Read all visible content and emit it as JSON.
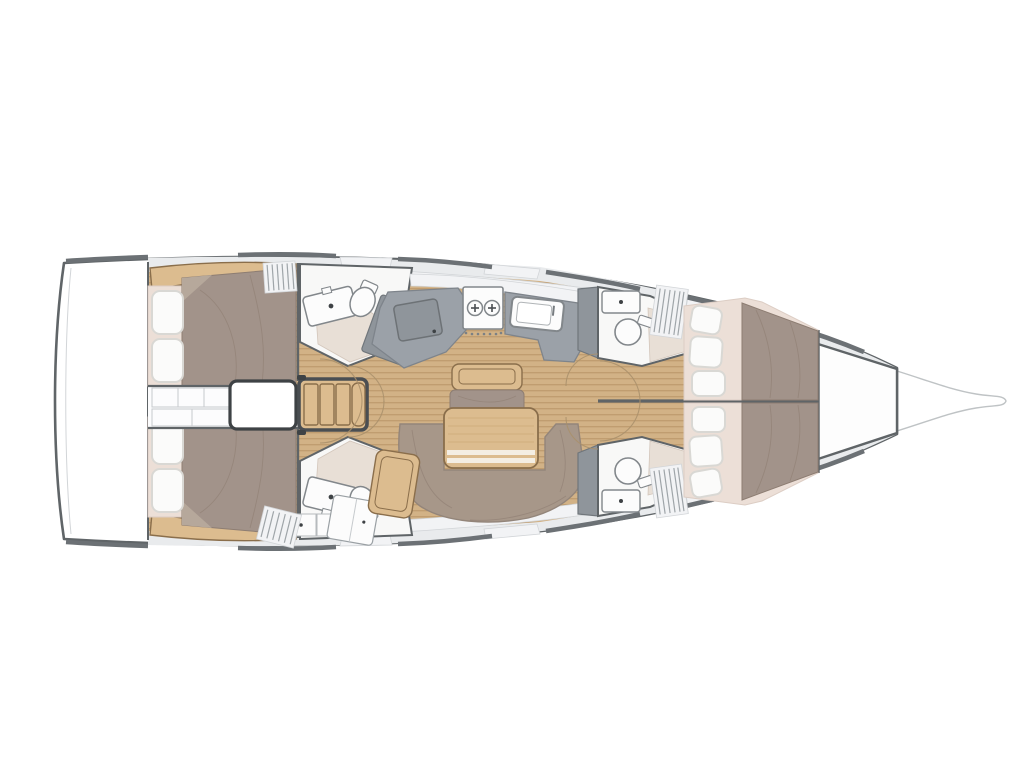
{
  "colors": {
    "bg": "#ffffff",
    "hull": "#606568",
    "rail": "#6c7175",
    "deck": "#e9ebed",
    "deck_seam": "#d2d5d8",
    "panel": "#f2f3f5",
    "wall": "#5f6467",
    "wood": "#d2b286",
    "wood_dark": "#bf9c6e",
    "furn": "#dcbc8f",
    "furn_edge": "#8a6e4b",
    "counter": "#9ba1a8",
    "counter_dark": "#7e848b",
    "locker": "#8f959b",
    "duvet": "#a2938a",
    "duvet_shade": "#8d7d72",
    "sofa": "#a79789",
    "cream": "#ecdfd7",
    "shower": "#e8dfd6",
    "pillow": "#fbfbfa",
    "pillow_edge": "#d9d8d4",
    "white_room": "#f8f8f7",
    "arc": "#a98f6b",
    "hatchln": "#9fa5a9",
    "handle": "#3e4245"
  },
  "plan": {
    "type": "sailboat-interior-floor-plan",
    "orientation": "bow-right",
    "cabins": [
      "aft-cabin-port",
      "aft-cabin-starboard",
      "forward-cabin-port",
      "forward-cabin-starboard"
    ],
    "heads": [
      "aft-head-port",
      "aft-head-starboard",
      "forward-head-port",
      "forward-head-starboard"
    ],
    "zones": [
      "stern-platform",
      "engine-compartment",
      "companionway-stairs",
      "galley",
      "salon",
      "nav-seat",
      "bow-locker",
      "bowsprit"
    ],
    "fixtures": [
      "double-berth",
      "berth-pillows",
      "two-burner-stove",
      "galley-sink",
      "fridge-hatch",
      "washbasin",
      "toilet",
      "shower-floor",
      "u-shaped-sofa",
      "folding-table",
      "centerline-bench",
      "hanging-locker",
      "door-swing-arcs"
    ]
  }
}
